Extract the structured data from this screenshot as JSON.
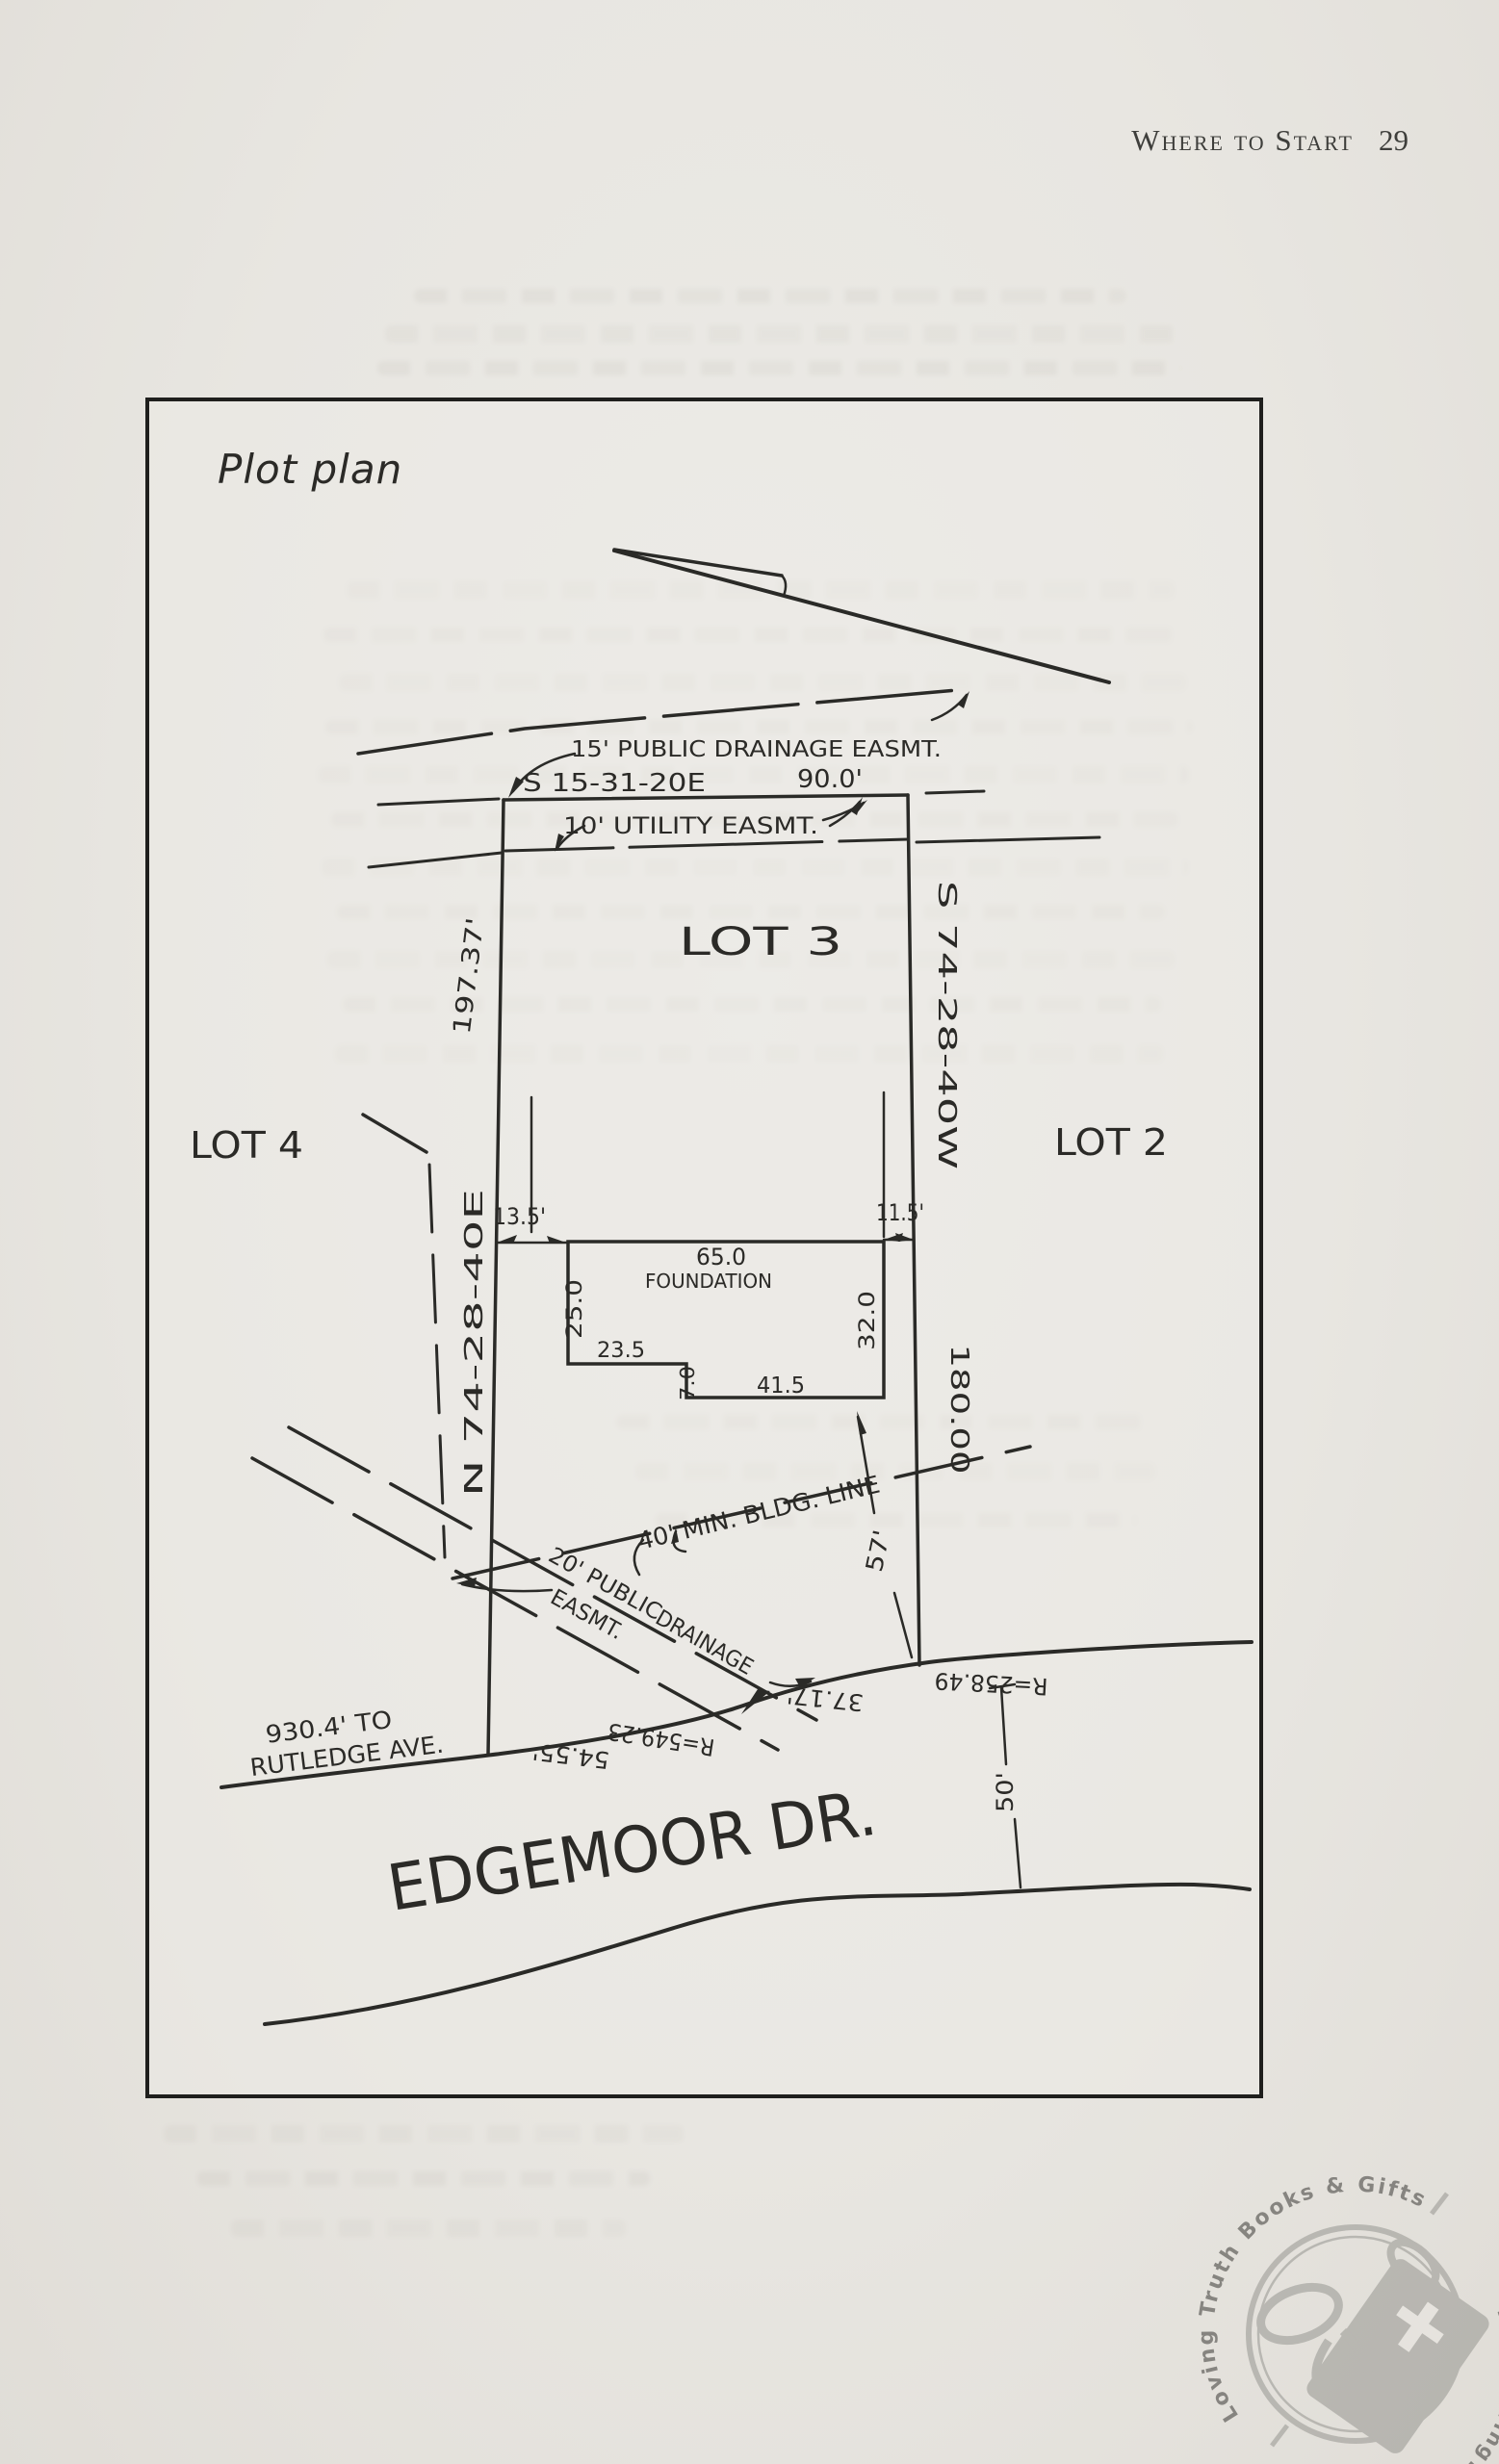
{
  "page": {
    "header": {
      "title": "Where to Start",
      "page_number": "29"
    }
  },
  "figure": {
    "title": "Plot plan",
    "lots": {
      "lot2": "LOT 2",
      "lot3": "LOT 3",
      "lot4": "LOT 4"
    },
    "boundaries": {
      "north_bearing": "S 15-31-20E",
      "north_length": "90.0'",
      "west_length": "197.37'",
      "west_bearing": "N 74-28-40E",
      "east_bearing": "S 74-28-40W",
      "east_length": "180.00"
    },
    "easements": {
      "drainage15": "15' PUBLIC DRAINAGE EASMT.",
      "utility10": "10' UTILITY EASMT.",
      "drainage20_part1": "20' PUBLIC",
      "drainage20_part2": "EASMT.",
      "drainage20_part3": "DRAINAGE"
    },
    "building_line": "40' MIN. BLDG. LINE",
    "foundation": {
      "label": "FOUNDATION",
      "top": "65.0",
      "west": "25.0",
      "east": "32.0",
      "step": "23.5",
      "notch": "7.0",
      "bottom": "41.5",
      "setback_west": "13.5'",
      "setback_east": "11.5'",
      "setback_front": "57'"
    },
    "street": {
      "name": "EDGEMOOR DR.",
      "to_note_line1": "930.4' TO",
      "to_note_line2": "RUTLEDGE AVE.",
      "radius1": "R=549.23",
      "arc1": "54.55'",
      "arc2": "37.17'",
      "radius2": "R=258.49",
      "right_of_way": "50'"
    }
  },
  "watermark": {
    "arc_top": "Loving Truth Books & Gifts",
    "arc_bottom": "www.LovingTruthBooks.com"
  },
  "colors": {
    "ink": "#2a2a27",
    "paper": "#eae8e3",
    "stamp": "#8f8f8a"
  }
}
